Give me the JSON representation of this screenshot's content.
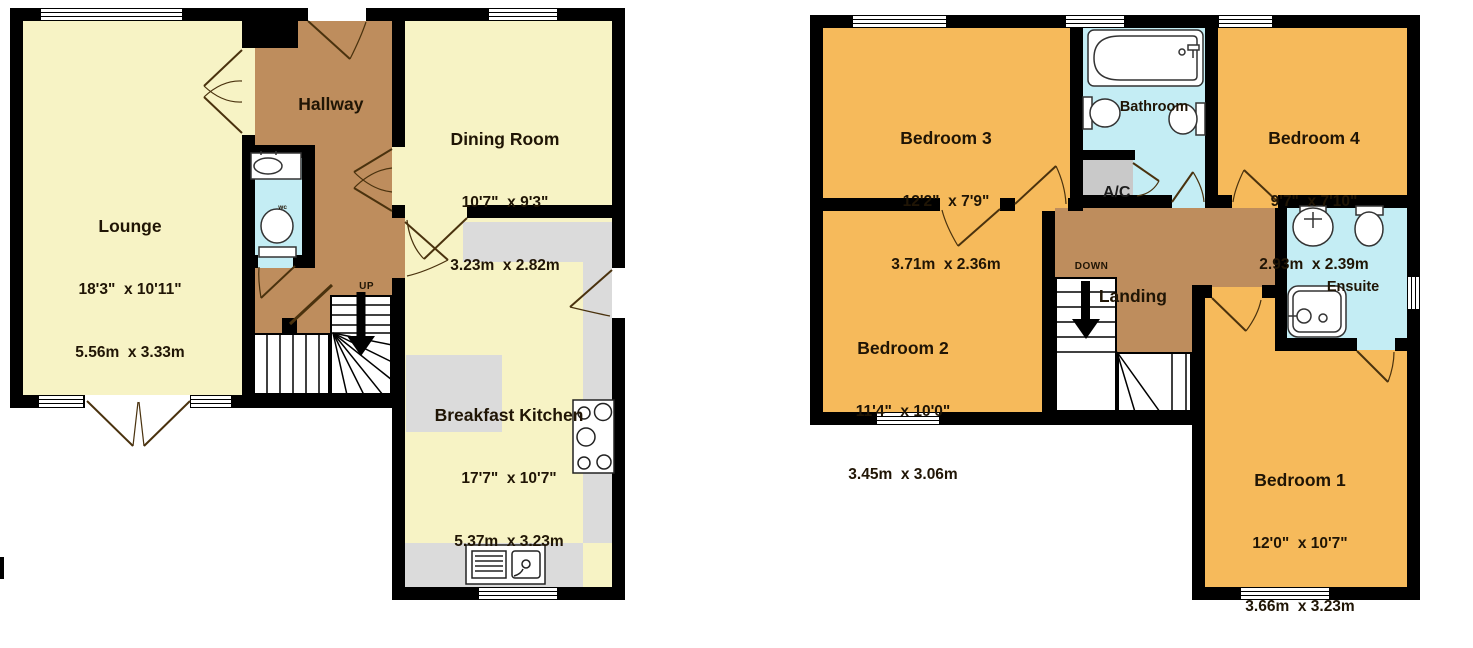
{
  "colors": {
    "wall_black": "#000000",
    "room_yellow": "#F7F3C5",
    "room_orange": "#F6BA5B",
    "hall_brown": "#BE8D5D",
    "bath_cyan": "#C4EDF4",
    "closet_gray": "#C9C9C9",
    "counter_gray": "#DBDBDB",
    "label_text": "#201505"
  },
  "ground_floor": {
    "stairs_label": "UP",
    "rooms": {
      "lounge": {
        "name": "Lounge",
        "imperial": "18'3\"  x 10'11\"",
        "metric": "5.56m  x 3.33m"
      },
      "hallway": {
        "name": "Hallway"
      },
      "dining_room": {
        "name": "Dining Room",
        "imperial": "10'7\"  x 9'3\"",
        "metric": "3.23m  x 2.82m"
      },
      "breakfast_kitchen": {
        "name": "Breakfast Kitchen",
        "imperial": "17'7\"  x 10'7\"",
        "metric": "5.37m  x 3.23m"
      },
      "wc": {
        "name": "wc"
      }
    }
  },
  "first_floor": {
    "stairs_label": "DOWN",
    "rooms": {
      "bedroom_1": {
        "name": "Bedroom 1",
        "imperial": "12'0\"  x 10'7\"",
        "metric": "3.66m  x 3.23m"
      },
      "bedroom_2": {
        "name": "Bedroom 2",
        "imperial": "11'4\"  x 10'0\"",
        "metric": "3.45m  x 3.06m"
      },
      "bedroom_3": {
        "name": "Bedroom 3",
        "imperial": "12'2\"  x 7'9\"",
        "metric": "3.71m  x 2.36m"
      },
      "bedroom_4": {
        "name": "Bedroom 4",
        "imperial": "9'7\"  x 7'10\"",
        "metric": "2.93m  x 2.39m"
      },
      "bathroom": {
        "name": "Bathroom"
      },
      "ensuite": {
        "name": "Ensuite"
      },
      "landing": {
        "name": "Landing"
      },
      "ac_closet": {
        "name": "A/C"
      }
    }
  }
}
